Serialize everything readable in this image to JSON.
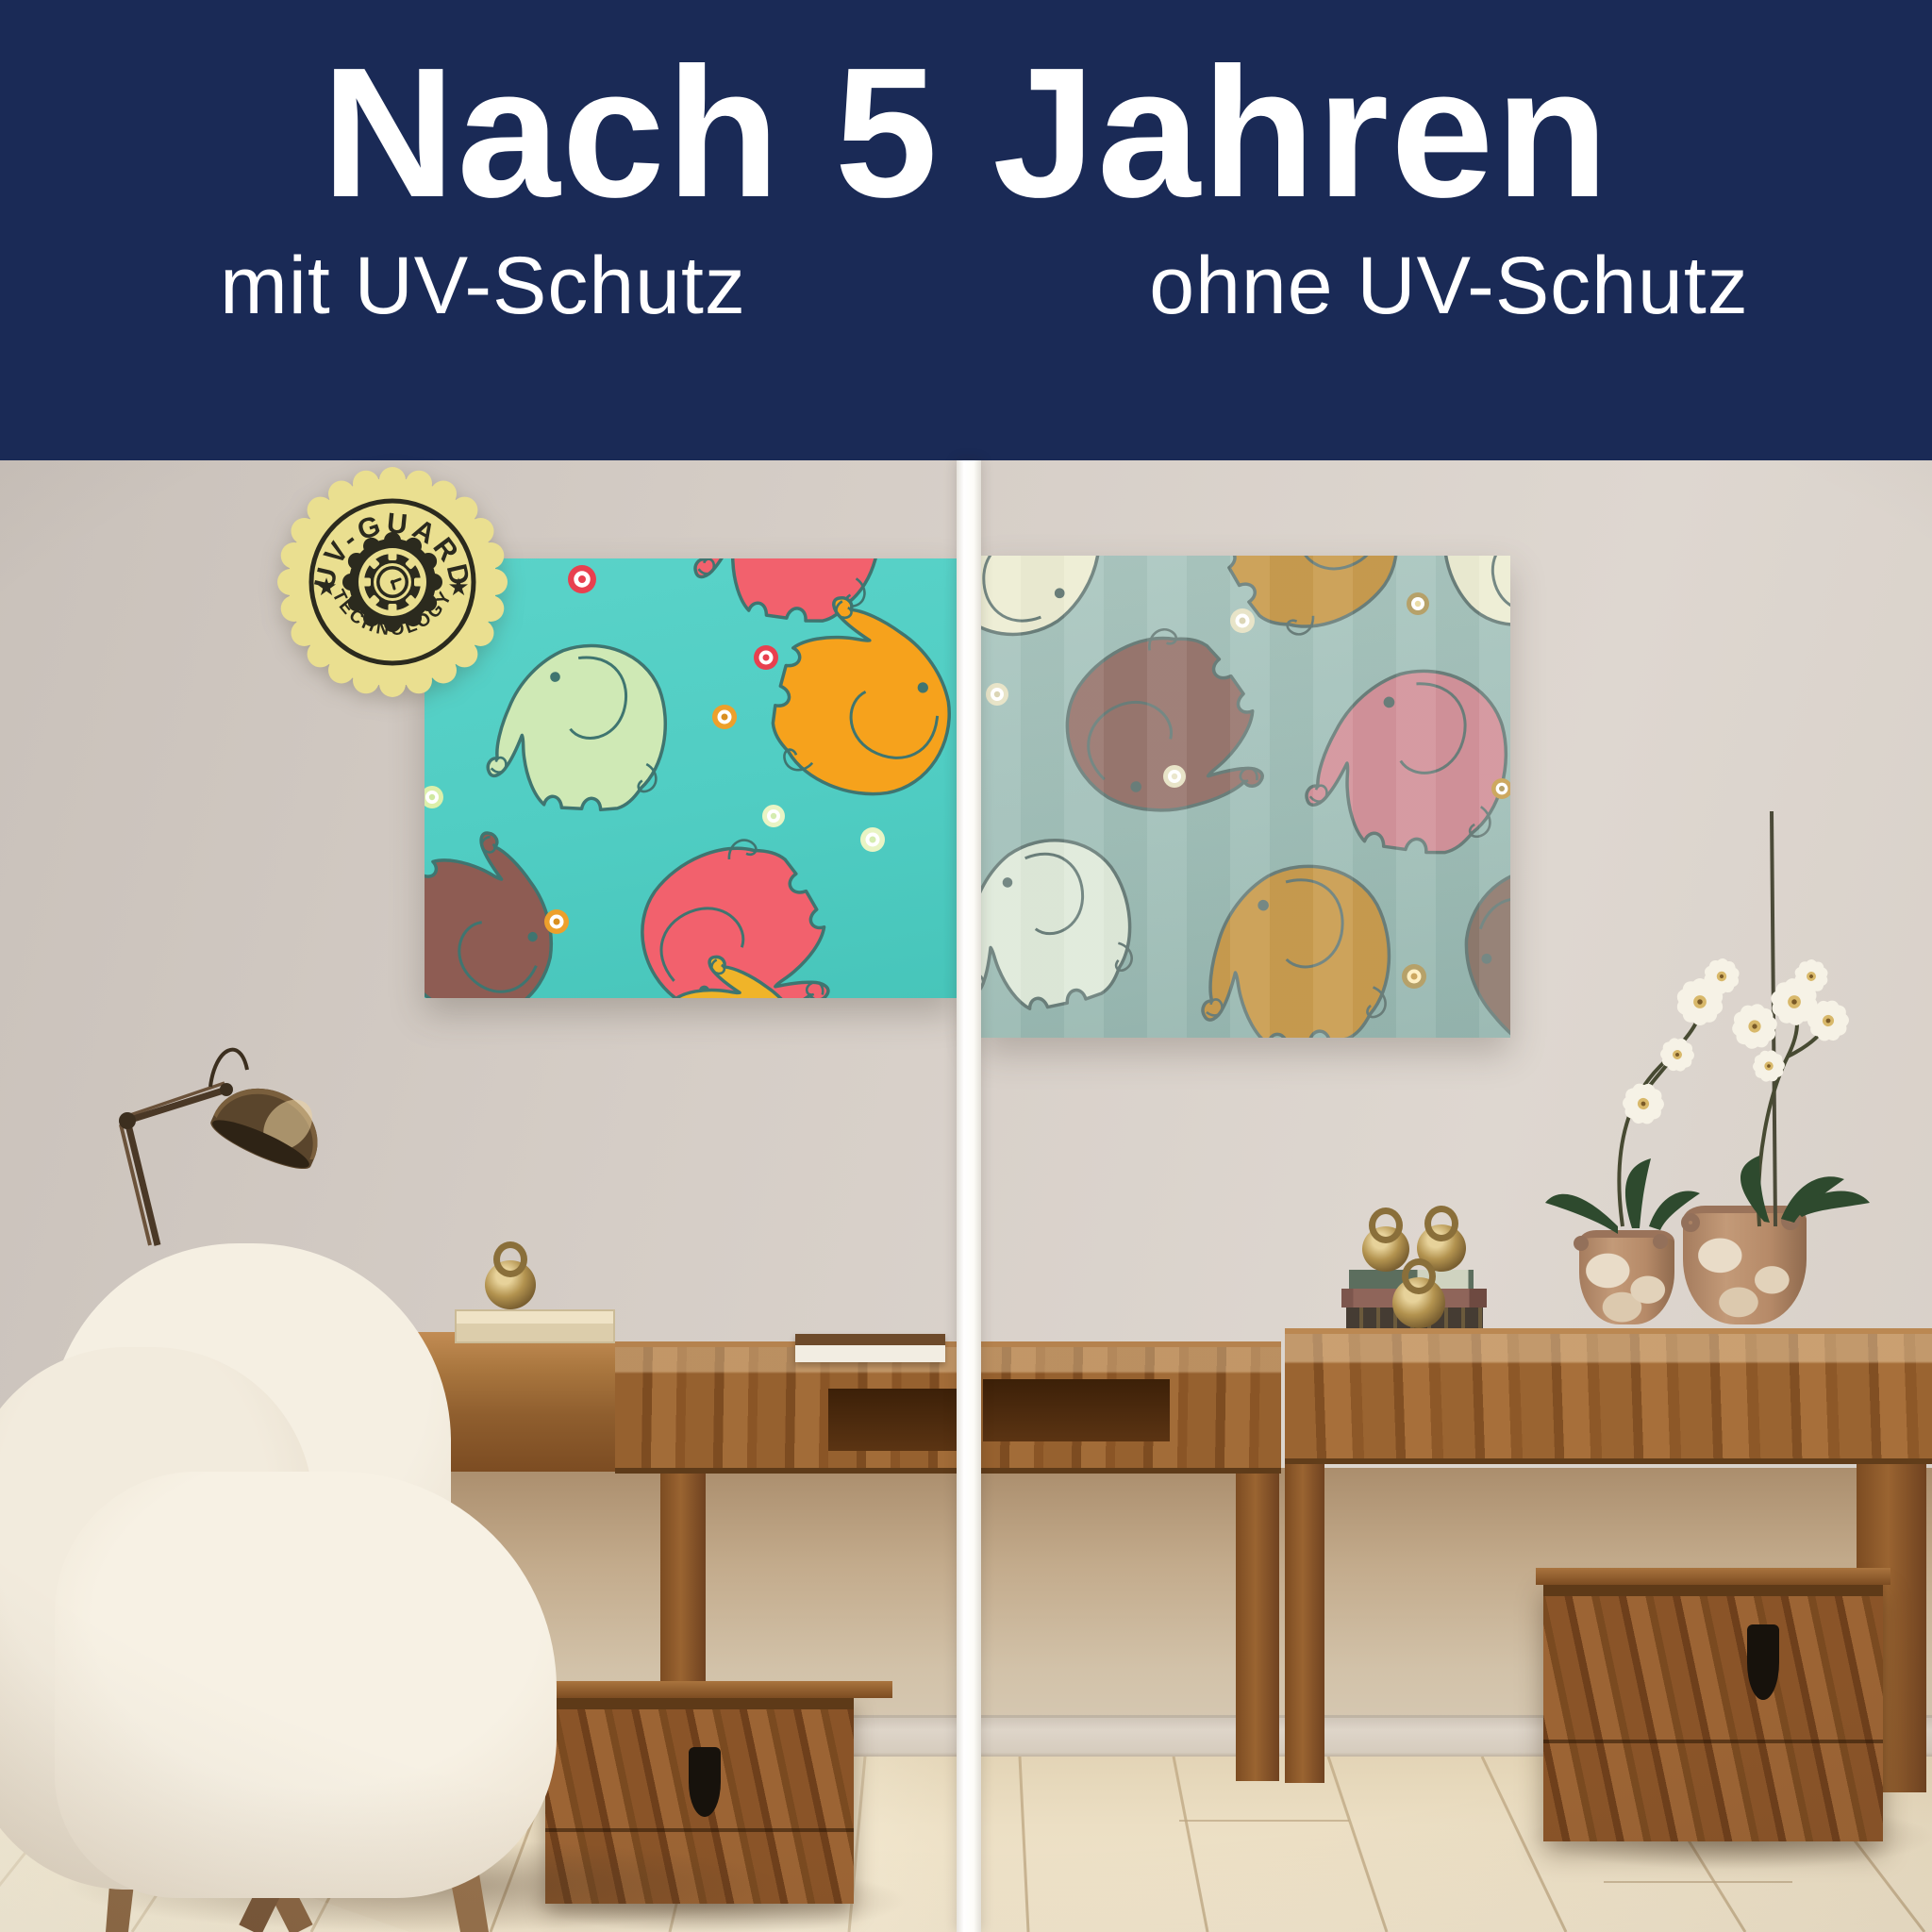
{
  "header": {
    "title": "Nach 5 Jahren",
    "label_left": "mit UV-Schutz",
    "label_right": "ohne UV-Schutz"
  },
  "badge": {
    "arc_top": "UV-GUARD",
    "arc_bottom": "TECHNOLOGY",
    "star": "★"
  },
  "colors": {
    "header_bg": "#1a2a56",
    "header_text": "#ffffff",
    "divider": "#fdfcf8",
    "badge_bg": "#eadf90",
    "badge_ink": "#2b2a1e",
    "mural_vivid_bg": "#53cfc5",
    "mural_faded_bg": "#a5c3bc",
    "wall": "#d6cec7",
    "wood": "#9c6434",
    "floor": "#e9dcc1"
  },
  "mural_vivid": {
    "elephant_colors": [
      "#cfe9b5",
      "#f6a21c",
      "#f2616d",
      "#8e5c53",
      "#f0b429"
    ],
    "outline": "#3f7570",
    "dot_colors": [
      "#e8404f",
      "#eda02b",
      "#dcefaa"
    ]
  },
  "mural_faded": {
    "elephant_colors": [
      "#ededd3",
      "#c99c4f",
      "#99776f",
      "#d3939b",
      "#dfeada",
      "#8f7a6e"
    ],
    "outline": "#6b7f7b",
    "dot_colors": [
      "#e6e2c4",
      "#b09a5e",
      "#c9a254"
    ]
  }
}
